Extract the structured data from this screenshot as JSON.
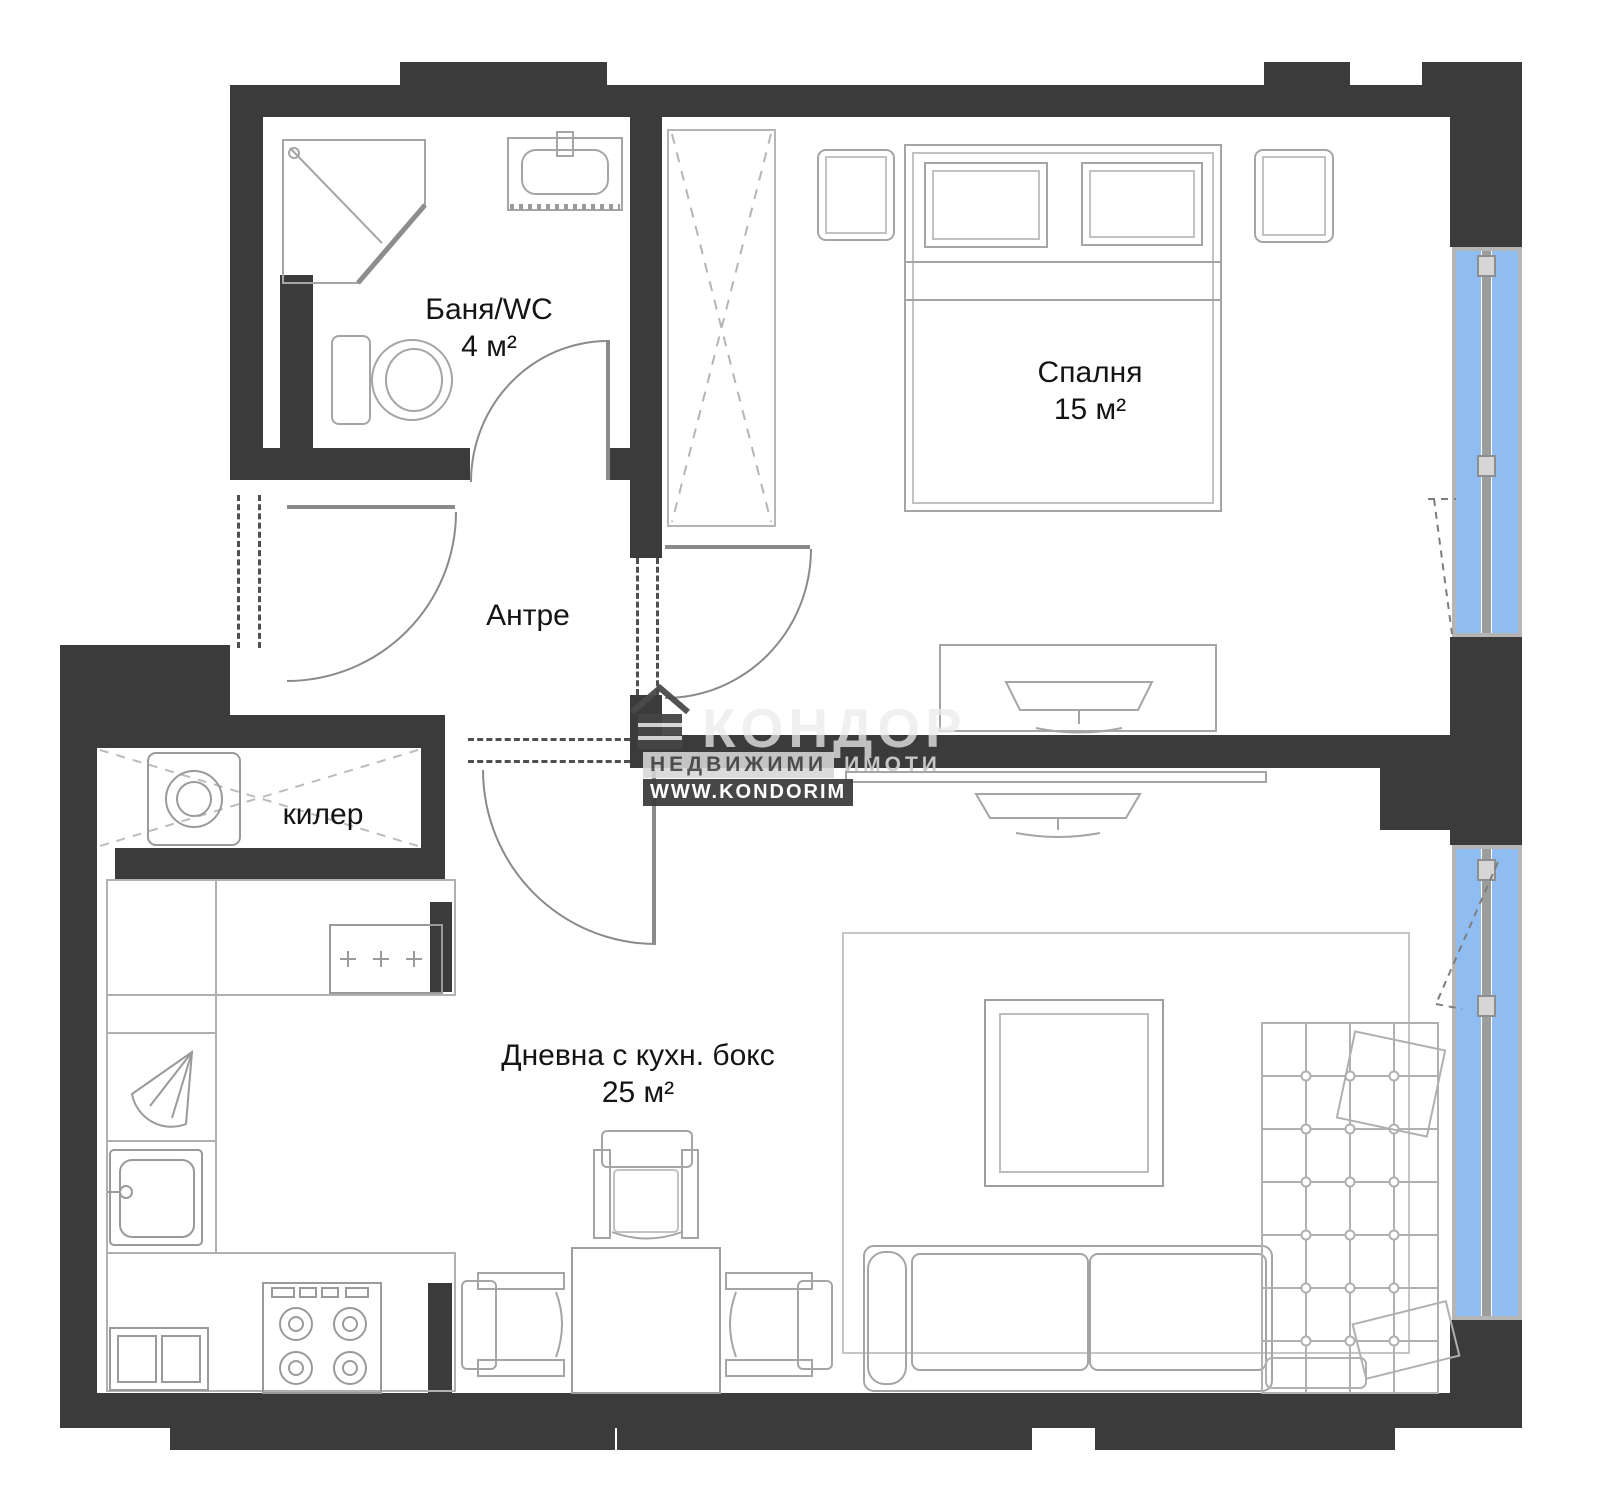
{
  "rooms": {
    "bathroom": {
      "name": "Баня/WC",
      "area": "4 м²"
    },
    "bedroom": {
      "name": "Спалня",
      "area": "15 м²"
    },
    "hall": {
      "name": "Антре"
    },
    "pantry": {
      "name": "килер"
    },
    "living": {
      "name": "Дневна с кухн. бокс",
      "area": "25 м²"
    }
  },
  "watermark": {
    "brand": "КОНДОР",
    "tagline": "НЕДВИЖИМИ",
    "tagline_ghost": "ИМОТИ",
    "website": "WWW.KONDORIM"
  },
  "colors": {
    "wall": "#3b3b3b",
    "window_glass": "#8fbdf1",
    "window_frame": "#b5b5b5",
    "furniture_line": "#a5a5a5"
  }
}
